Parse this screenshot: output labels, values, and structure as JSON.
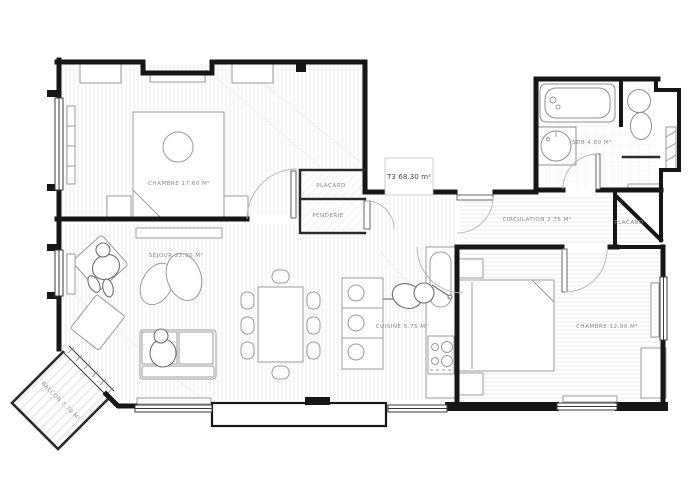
{
  "plan": {
    "title": "T3 68.30 m²",
    "rooms": [
      {
        "id": "chambre-1",
        "label": "CHAMBRE 17.60 M²"
      },
      {
        "id": "sejour",
        "label": "SÉJOUR 22.30 M²"
      },
      {
        "id": "placard-1",
        "label": "PLACARD"
      },
      {
        "id": "penderie",
        "label": "PENDERIE"
      },
      {
        "id": "circulation",
        "label": "CIRCULATION 2.75 M²"
      },
      {
        "id": "sdb",
        "label": "SDB 4.80 M²"
      },
      {
        "id": "placard-2",
        "label": "PLACARD"
      },
      {
        "id": "chambre-2",
        "label": "CHAMBRE 12.90 M²"
      },
      {
        "id": "cuisine",
        "label": "CUISINE 5.75 M²"
      },
      {
        "id": "balcon",
        "label": "BALCON 7.70 M²"
      }
    ],
    "colors": {
      "wall": "#161616",
      "furniture_outline": "#9b9b9b",
      "floor_hatch": "#e6e6e6",
      "label_text": "#8a8a8a",
      "background": "#ffffff"
    }
  }
}
